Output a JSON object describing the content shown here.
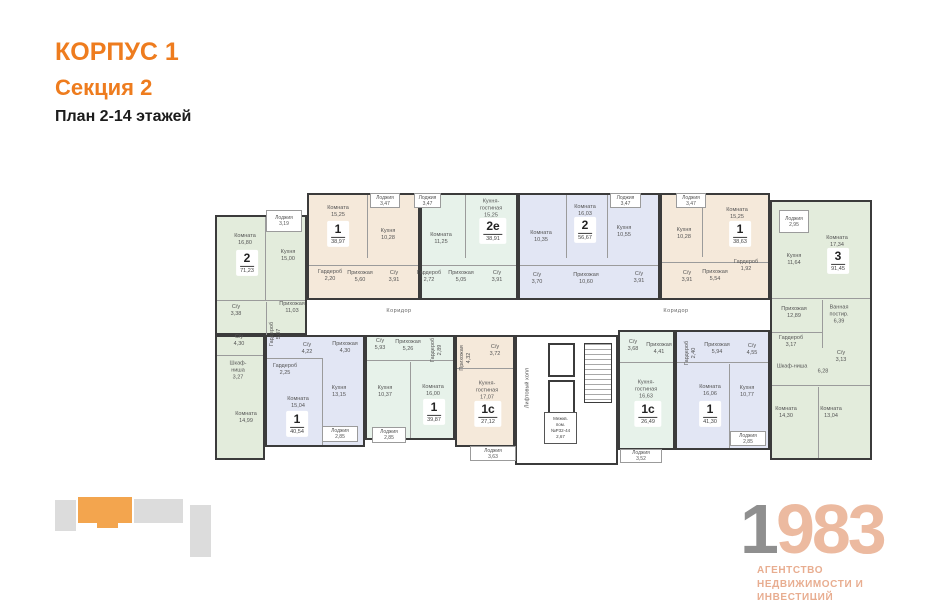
{
  "header": {
    "building": "КОРПУС 1",
    "section": "Секция 2",
    "plan": "План 2-14 этажей"
  },
  "logo": {
    "year_gray": "1",
    "year_rest": "983",
    "line1": "АГЕНТСТВО",
    "line2": "НЕДВИЖИМОСТИ И ИНВЕСТИЦИЙ"
  },
  "colors": {
    "orange": "#ee7c1e",
    "wall": "#3b3b3b",
    "sage": "#e3ecdc",
    "mint": "#e7f2ea",
    "tan": "#f5e9da",
    "blue": "#e2e6f4",
    "logo_gray": "#8f8f8f",
    "logo_salmon": "#ecbaa0",
    "minimap_orange": "#f3a54e",
    "minimap_gray": "#dcdcdc"
  },
  "minimap": {
    "blocks": [
      {
        "x": 55,
        "y": 500,
        "w": 21,
        "h": 31,
        "c": "gray"
      },
      {
        "x": 78,
        "y": 497,
        "w": 54,
        "h": 26,
        "c": "orange"
      },
      {
        "x": 97,
        "y": 522,
        "w": 21,
        "h": 6,
        "c": "orange"
      },
      {
        "x": 134,
        "y": 499,
        "w": 49,
        "h": 24,
        "c": "gray"
      },
      {
        "x": 190,
        "y": 505,
        "w": 21,
        "h": 52,
        "c": "gray"
      }
    ]
  },
  "plan": {
    "corridor_labels": [
      {
        "text": "Коридор",
        "x": 399,
        "y": 311
      },
      {
        "text": "Коридор",
        "x": 676,
        "y": 311
      }
    ],
    "extra_labels": [
      {
        "lines": [
          "6,28"
        ],
        "x": 823,
        "y": 372
      }
    ],
    "core": {
      "zone": {
        "x": 515,
        "y": 335,
        "w": 103,
        "h": 130
      },
      "lifts": [
        {
          "x": 548,
          "y": 343,
          "w": 27,
          "h": 34
        },
        {
          "x": 548,
          "y": 380,
          "w": 27,
          "h": 34
        }
      ],
      "stairs": {
        "x": 584,
        "y": 343,
        "w": 28,
        "h": 60
      },
      "hall_label": {
        "text": "Лифтовый холл",
        "x": 528,
        "y": 388
      },
      "tech": {
        "box": {
          "x": 544,
          "y": 412,
          "w": 33,
          "h": 32
        },
        "lines": [
          "Межкв.",
          "пом.",
          "№Р32-44",
          "2,67"
        ]
      }
    },
    "partitions": [
      [
        265,
        217,
        1,
        83
      ],
      [
        217,
        300,
        88,
        1
      ],
      [
        217,
        355,
        46,
        1
      ],
      [
        266,
        302,
        1,
        33
      ],
      [
        367,
        195,
        1,
        63
      ],
      [
        309,
        265,
        109,
        1
      ],
      [
        465,
        195,
        1,
        63
      ],
      [
        422,
        265,
        94,
        1
      ],
      [
        566,
        195,
        1,
        63
      ],
      [
        607,
        195,
        1,
        63
      ],
      [
        520,
        265,
        138,
        1
      ],
      [
        702,
        195,
        1,
        62
      ],
      [
        662,
        262,
        106,
        1
      ],
      [
        772,
        298,
        98,
        1
      ],
      [
        772,
        385,
        98,
        1
      ],
      [
        818,
        387,
        1,
        71
      ],
      [
        822,
        300,
        1,
        48
      ],
      [
        772,
        332,
        50,
        1
      ],
      [
        322,
        358,
        1,
        87
      ],
      [
        267,
        358,
        55,
        1
      ],
      [
        367,
        360,
        86,
        1
      ],
      [
        410,
        362,
        1,
        76
      ],
      [
        457,
        368,
        56,
        1
      ],
      [
        620,
        362,
        53,
        1
      ],
      [
        677,
        362,
        91,
        1
      ],
      [
        729,
        364,
        1,
        84
      ]
    ],
    "apartments": [
      {
        "number": "2",
        "total": "71,23",
        "color": "sage",
        "zones": [
          {
            "x": 215,
            "y": 215,
            "w": 92,
            "h": 120
          },
          {
            "x": 215,
            "y": 335,
            "w": 50,
            "h": 125
          }
        ],
        "badge": {
          "x": 247,
          "y": 263
        },
        "rooms": [
          {
            "lines": [
              "Комната",
              "16,80"
            ],
            "x": 245,
            "y": 240
          },
          {
            "lines": [
              "Кухня",
              "15,00"
            ],
            "x": 288,
            "y": 256
          },
          {
            "lines": [
              "Прихожая",
              "11,03"
            ],
            "x": 292,
            "y": 308
          },
          {
            "lines": [
              "С/у",
              "3,38"
            ],
            "x": 236,
            "y": 311
          },
          {
            "lines": [
              "С/у",
              "4,30"
            ],
            "x": 239,
            "y": 341
          },
          {
            "lines": [
              "Гардероб",
              "5,07"
            ],
            "x": 276,
            "y": 334,
            "v": true
          },
          {
            "lines": [
              "Шкаф-",
              "ниша",
              "3,27"
            ],
            "x": 238,
            "y": 371
          },
          {
            "lines": [
              "Комната",
              "14,99"
            ],
            "x": 246,
            "y": 418
          }
        ],
        "loggias": [
          {
            "box": {
              "x": 266,
              "y": 210,
              "w": 36,
              "h": 22
            },
            "lines": [
              "Лоджия",
              "3,19"
            ]
          }
        ]
      },
      {
        "number": "1",
        "total": "38,97",
        "color": "tan",
        "zones": [
          {
            "x": 307,
            "y": 193,
            "w": 113,
            "h": 107
          }
        ],
        "badge": {
          "x": 338,
          "y": 234
        },
        "rooms": [
          {
            "lines": [
              "Комната",
              "15,25"
            ],
            "x": 338,
            "y": 212
          },
          {
            "lines": [
              "Кухня",
              "10,28"
            ],
            "x": 388,
            "y": 235
          },
          {
            "lines": [
              "Гардероб",
              "2,20"
            ],
            "x": 330,
            "y": 276
          },
          {
            "lines": [
              "Прихожая",
              "5,60"
            ],
            "x": 360,
            "y": 277
          },
          {
            "lines": [
              "С/у",
              "3,91"
            ],
            "x": 394,
            "y": 277
          }
        ],
        "loggias": [
          {
            "box": {
              "x": 370,
              "y": 193,
              "w": 30,
              "h": 15
            },
            "lines": [
              "Лоджия",
              "3,47"
            ]
          }
        ]
      },
      {
        "number": "2е",
        "total": "38,91",
        "color": "mint",
        "zones": [
          {
            "x": 420,
            "y": 193,
            "w": 98,
            "h": 107
          }
        ],
        "badge": {
          "x": 493,
          "y": 231
        },
        "rooms": [
          {
            "lines": [
              "Кухня-",
              "гостиная",
              "15,25"
            ],
            "x": 491,
            "y": 209
          },
          {
            "lines": [
              "Комната",
              "11,25"
            ],
            "x": 441,
            "y": 239
          },
          {
            "lines": [
              "Гардероб",
              "2,72"
            ],
            "x": 429,
            "y": 277
          },
          {
            "lines": [
              "Прихожая",
              "5,05"
            ],
            "x": 461,
            "y": 277
          },
          {
            "lines": [
              "С/у",
              "3,91"
            ],
            "x": 497,
            "y": 277
          }
        ],
        "loggias": [
          {
            "box": {
              "x": 414,
              "y": 193,
              "w": 27,
              "h": 15
            },
            "lines": [
              "Лоджия",
              "3,47"
            ]
          }
        ]
      },
      {
        "number": "2",
        "total": "56,67",
        "color": "blue",
        "zones": [
          {
            "x": 518,
            "y": 193,
            "w": 142,
            "h": 107
          }
        ],
        "badge": {
          "x": 585,
          "y": 230
        },
        "rooms": [
          {
            "lines": [
              "Комната",
              "16,03"
            ],
            "x": 585,
            "y": 211
          },
          {
            "lines": [
              "Комната",
              "10,35"
            ],
            "x": 541,
            "y": 237
          },
          {
            "lines": [
              "Кухня",
              "10,55"
            ],
            "x": 624,
            "y": 232
          },
          {
            "lines": [
              "С/у",
              "3,70"
            ],
            "x": 537,
            "y": 279
          },
          {
            "lines": [
              "Прихожая",
              "10,60"
            ],
            "x": 586,
            "y": 279
          },
          {
            "lines": [
              "С/у",
              "3,91"
            ],
            "x": 639,
            "y": 278
          }
        ],
        "loggias": [
          {
            "box": {
              "x": 610,
              "y": 193,
              "w": 31,
              "h": 15
            },
            "lines": [
              "Лоджия",
              "3,47"
            ]
          }
        ]
      },
      {
        "number": "1",
        "total": "38,63",
        "color": "tan",
        "zones": [
          {
            "x": 660,
            "y": 193,
            "w": 110,
            "h": 107
          }
        ],
        "badge": {
          "x": 740,
          "y": 234
        },
        "rooms": [
          {
            "lines": [
              "Комната",
              "15,25"
            ],
            "x": 737,
            "y": 214
          },
          {
            "lines": [
              "Кухня",
              "10,28"
            ],
            "x": 684,
            "y": 234
          },
          {
            "lines": [
              "С/у",
              "3,91"
            ],
            "x": 687,
            "y": 277
          },
          {
            "lines": [
              "Прихожая",
              "5,54"
            ],
            "x": 715,
            "y": 276
          },
          {
            "lines": [
              "Гардероб",
              "1,92"
            ],
            "x": 746,
            "y": 266
          }
        ],
        "loggias": [
          {
            "box": {
              "x": 676,
              "y": 193,
              "w": 30,
              "h": 15
            },
            "lines": [
              "Лоджия",
              "3,47"
            ]
          }
        ]
      },
      {
        "number": "3",
        "total": "91,45",
        "color": "sage",
        "zones": [
          {
            "x": 770,
            "y": 200,
            "w": 102,
            "h": 260
          }
        ],
        "badge": {
          "x": 838,
          "y": 261
        },
        "rooms": [
          {
            "lines": [
              "Комната",
              "17,34"
            ],
            "x": 837,
            "y": 242
          },
          {
            "lines": [
              "Кухня",
              "11,64"
            ],
            "x": 794,
            "y": 260
          },
          {
            "lines": [
              "Прихожая",
              "12,89"
            ],
            "x": 794,
            "y": 313
          },
          {
            "lines": [
              "Ванная",
              "постир.",
              "6,39"
            ],
            "x": 839,
            "y": 315
          },
          {
            "lines": [
              "Гардероб",
              "3,17"
            ],
            "x": 791,
            "y": 342
          },
          {
            "lines": [
              "Шкаф-ниша"
            ],
            "x": 792,
            "y": 367
          },
          {
            "lines": [
              "С/у",
              "3,13"
            ],
            "x": 841,
            "y": 357
          },
          {
            "lines": [
              "Комната",
              "14,30"
            ],
            "x": 786,
            "y": 413
          },
          {
            "lines": [
              "Комната",
              "13,04"
            ],
            "x": 831,
            "y": 413
          }
        ],
        "loggias": [
          {
            "box": {
              "x": 779,
              "y": 210,
              "w": 30,
              "h": 23
            },
            "lines": [
              "Лоджия",
              "2,95"
            ]
          }
        ]
      },
      {
        "number": "1",
        "total": "40,54",
        "color": "blue",
        "zones": [
          {
            "x": 265,
            "y": 335,
            "w": 100,
            "h": 112
          }
        ],
        "badge": {
          "x": 297,
          "y": 424
        },
        "rooms": [
          {
            "lines": [
              "С/у",
              "4,22"
            ],
            "x": 307,
            "y": 349
          },
          {
            "lines": [
              "Прихожая",
              "4,30"
            ],
            "x": 345,
            "y": 348
          },
          {
            "lines": [
              "Гардероб",
              "2,25"
            ],
            "x": 285,
            "y": 370
          },
          {
            "lines": [
              "Комната",
              "15,04"
            ],
            "x": 298,
            "y": 403
          },
          {
            "lines": [
              "Кухня",
              "13,15"
            ],
            "x": 339,
            "y": 392
          }
        ],
        "loggias": [
          {
            "box": {
              "x": 322,
              "y": 426,
              "w": 36,
              "h": 16
            },
            "lines": [
              "Лоджия",
              "2,85"
            ]
          }
        ]
      },
      {
        "number": "1",
        "total": "39,87",
        "color": "mint",
        "zones": [
          {
            "x": 365,
            "y": 335,
            "w": 90,
            "h": 105
          }
        ],
        "badge": {
          "x": 434,
          "y": 412
        },
        "rooms": [
          {
            "lines": [
              "С/у",
              "5,93"
            ],
            "x": 380,
            "y": 345
          },
          {
            "lines": [
              "Прихожая",
              "5,26"
            ],
            "x": 408,
            "y": 346
          },
          {
            "lines": [
              "Гардероб",
              "2,89"
            ],
            "x": 437,
            "y": 350,
            "v": true
          },
          {
            "lines": [
              "Кухня",
              "10,37"
            ],
            "x": 385,
            "y": 392
          },
          {
            "lines": [
              "Комната",
              "16,00"
            ],
            "x": 433,
            "y": 391
          }
        ],
        "loggias": [
          {
            "box": {
              "x": 372,
              "y": 427,
              "w": 34,
              "h": 16
            },
            "lines": [
              "Лоджия",
              "2,85"
            ]
          }
        ]
      },
      {
        "number": "1с",
        "total": "27,12",
        "color": "tan",
        "zones": [
          {
            "x": 455,
            "y": 335,
            "w": 60,
            "h": 112
          }
        ],
        "badge": {
          "x": 488,
          "y": 414
        },
        "rooms": [
          {
            "lines": [
              "Прихожая",
              "4,32"
            ],
            "x": 466,
            "y": 358,
            "v": true
          },
          {
            "lines": [
              "С/у",
              "3,72"
            ],
            "x": 495,
            "y": 351
          },
          {
            "lines": [
              "Кухня-",
              "гостиная",
              "17,07"
            ],
            "x": 487,
            "y": 391
          }
        ],
        "loggias": [
          {
            "box": {
              "x": 470,
              "y": 446,
              "w": 46,
              "h": 15
            },
            "lines": [
              "Лоджия",
              "3,63"
            ]
          }
        ]
      },
      {
        "number": "1с",
        "total": "26,49",
        "color": "mint",
        "zones": [
          {
            "x": 618,
            "y": 330,
            "w": 57,
            "h": 120
          }
        ],
        "badge": {
          "x": 648,
          "y": 414
        },
        "rooms": [
          {
            "lines": [
              "С/у",
              "3,68"
            ],
            "x": 633,
            "y": 346
          },
          {
            "lines": [
              "Прихожая",
              "4,41"
            ],
            "x": 659,
            "y": 349
          },
          {
            "lines": [
              "Кухня-",
              "гостиная",
              "16,63"
            ],
            "x": 646,
            "y": 390
          }
        ],
        "loggias": [
          {
            "box": {
              "x": 620,
              "y": 449,
              "w": 42,
              "h": 14
            },
            "lines": [
              "Лоджия",
              "3,52"
            ]
          }
        ]
      },
      {
        "number": "1",
        "total": "41,30",
        "color": "blue",
        "zones": [
          {
            "x": 675,
            "y": 330,
            "w": 95,
            "h": 120
          }
        ],
        "badge": {
          "x": 710,
          "y": 414
        },
        "rooms": [
          {
            "lines": [
              "Гардероб",
              "2,40"
            ],
            "x": 691,
            "y": 353,
            "v": true
          },
          {
            "lines": [
              "Прихожая",
              "5,94"
            ],
            "x": 717,
            "y": 349
          },
          {
            "lines": [
              "С/у",
              "4,55"
            ],
            "x": 752,
            "y": 350
          },
          {
            "lines": [
              "Комната",
              "16,06"
            ],
            "x": 710,
            "y": 391
          },
          {
            "lines": [
              "Кухня",
              "10,77"
            ],
            "x": 747,
            "y": 392
          }
        ],
        "loggias": [
          {
            "box": {
              "x": 730,
              "y": 431,
              "w": 36,
              "h": 15
            },
            "lines": [
              "Лоджия",
              "2,85"
            ]
          }
        ]
      }
    ]
  }
}
